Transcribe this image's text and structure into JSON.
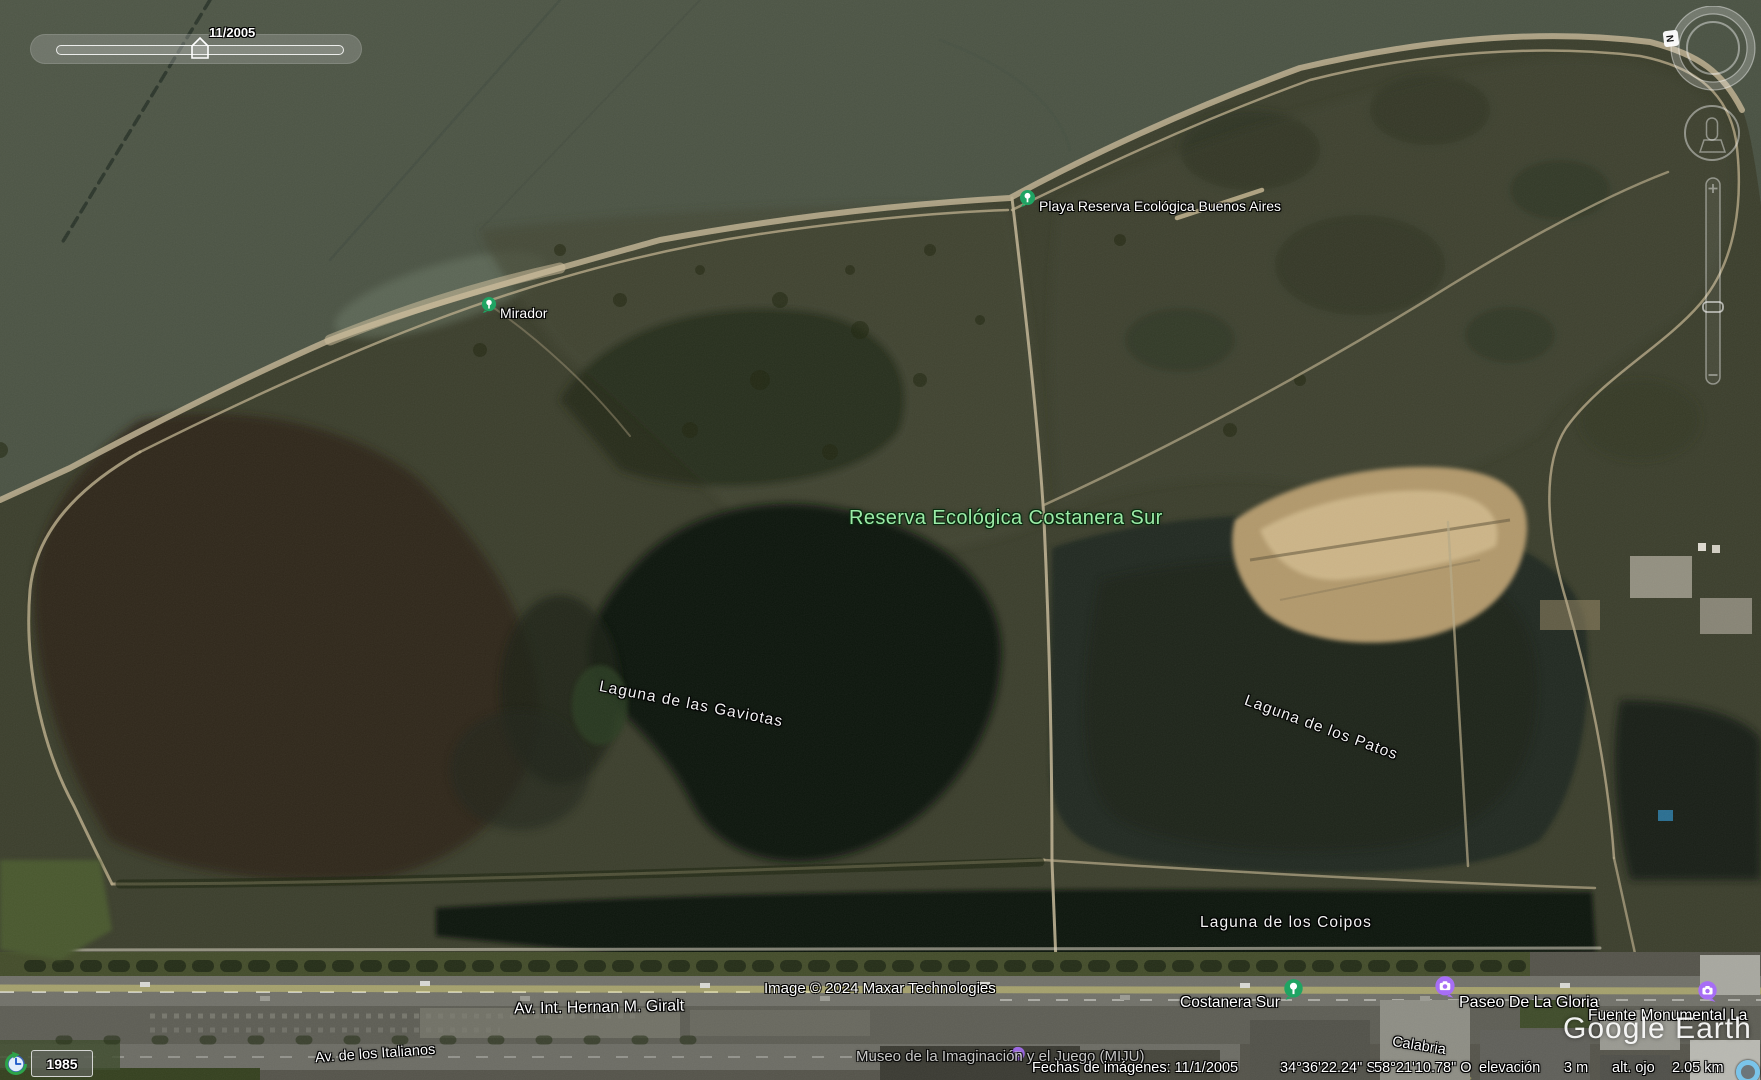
{
  "time_slider": {
    "date": "11/2005"
  },
  "history_box": {
    "year": "1985"
  },
  "compass": {
    "north": "N"
  },
  "map_labels": {
    "reserve_title": "Reserva Ecológica Costanera Sur",
    "lagoon_gaviotas": "Laguna de las Gaviotas",
    "lagoon_patos": "Laguna de los Patos",
    "lagoon_coipos": "Laguna de los Coipos"
  },
  "places": {
    "playa": "Playa Reserva Ecológica Buenos Aires",
    "mirador": "Mirador",
    "costanera_sur": "Costanera Sur",
    "paseo_gloria": "Paseo De La Gloria",
    "fuente": "Fuente Monumental La",
    "museo": "Museo de la Imaginación y el Juego (MIJU)"
  },
  "streets": {
    "giralt": "Av. Int. Hernan M. Giralt",
    "italianos": "Av. de los Italianos",
    "calabria": "Calabria"
  },
  "attribution": {
    "imagery": "Image © 2024 Maxar Technologies",
    "watermark": "Google Earth"
  },
  "status_bar": {
    "imagery_date": "Fechas de imágenes: 11/1/2005",
    "lat": "34°36'22.24\" S",
    "lon": "58°21'10.78\" O",
    "elev_label": "elevación",
    "elev_value": "3 m",
    "eye_label": "alt. ojo",
    "eye_value": "2.05 km"
  },
  "colors": {
    "park_icon": "#1fa463",
    "museum_icon": "#a76ef5",
    "reserve_label": "#9beba6",
    "road_overlay": "#d8cf6f"
  }
}
